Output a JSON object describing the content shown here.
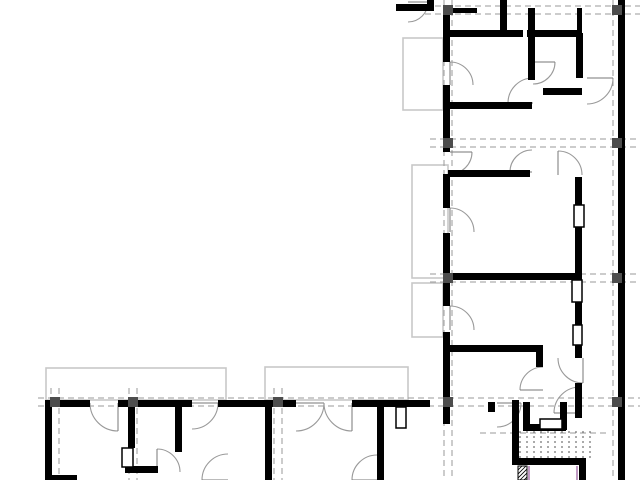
{
  "canvas": {
    "width": 640,
    "height": 480,
    "background": "#ffffff"
  },
  "colors": {
    "wall": "#000000",
    "grid": "#9a9a9a",
    "door_arc": "#999999",
    "balcony_outline": "#c8c8c8",
    "column": "#4d4d4d",
    "stair_tread": "#555555",
    "accent_magenta": "#96579b",
    "frame_border": "#000000",
    "frame_fill": "#ffffff"
  },
  "plan": {
    "grid": {
      "pair_offset": 4,
      "dash": "6 4",
      "vertical_axes": [
        {
          "x": 55,
          "y1": 388,
          "y2": 480
        },
        {
          "x": 133,
          "y1": 388,
          "y2": 480
        },
        {
          "x": 278,
          "y1": 388,
          "y2": 480
        },
        {
          "x": 448,
          "y1": 0,
          "y2": 480
        },
        {
          "x": 617,
          "y1": 0,
          "y2": 480
        }
      ],
      "horizontal_axes": [
        {
          "y": 10,
          "x1": 425,
          "x2": 640
        },
        {
          "y": 143,
          "x1": 430,
          "x2": 640
        },
        {
          "y": 278,
          "x1": 430,
          "x2": 640
        },
        {
          "y": 402,
          "x1": 38,
          "x2": 640
        }
      ],
      "extra_dashed_lines": [
        [
          480,
          433,
          610,
          433
        ]
      ]
    },
    "balconies": [
      [
        46,
        368,
        180,
        32
      ],
      [
        265,
        367,
        143,
        33
      ],
      [
        403,
        38,
        40,
        72
      ],
      [
        412,
        165,
        36,
        113
      ],
      [
        412,
        283,
        31,
        54
      ]
    ],
    "walls": [
      [
        443,
        8,
        7,
        54
      ],
      [
        443,
        85,
        7,
        67
      ],
      [
        443,
        174,
        7,
        34
      ],
      [
        443,
        233,
        7,
        73
      ],
      [
        443,
        332,
        7,
        70
      ],
      [
        443,
        402,
        7,
        22
      ],
      [
        618,
        0,
        7,
        480
      ],
      [
        500,
        0,
        7,
        35
      ],
      [
        528,
        8,
        7,
        72
      ],
      [
        577,
        8,
        5,
        25
      ],
      [
        443,
        30,
        80,
        7
      ],
      [
        527,
        30,
        53,
        7
      ],
      [
        452,
        8,
        25,
        5
      ],
      [
        396,
        4,
        38,
        7
      ],
      [
        427,
        0,
        7,
        11
      ],
      [
        448,
        102,
        84,
        7
      ],
      [
        543,
        88,
        39,
        7
      ],
      [
        576,
        33,
        7,
        45
      ],
      [
        448,
        170,
        82,
        7
      ],
      [
        575,
        177,
        7,
        28
      ],
      [
        575,
        227,
        7,
        53
      ],
      [
        575,
        302,
        7,
        23
      ],
      [
        575,
        345,
        7,
        13
      ],
      [
        575,
        383,
        7,
        19
      ],
      [
        448,
        273,
        129,
        7
      ],
      [
        450,
        345,
        90,
        7
      ],
      [
        536,
        345,
        7,
        22
      ],
      [
        512,
        400,
        7,
        62
      ],
      [
        512,
        458,
        74,
        7
      ],
      [
        579,
        458,
        7,
        22
      ],
      [
        523,
        402,
        7,
        22
      ],
      [
        523,
        424,
        43,
        7
      ],
      [
        560,
        402,
        7,
        28
      ],
      [
        575,
        402,
        7,
        16
      ],
      [
        488,
        402,
        7,
        10
      ],
      [
        45,
        400,
        45,
        7
      ],
      [
        118,
        400,
        74,
        7
      ],
      [
        218,
        400,
        78,
        7
      ],
      [
        352,
        400,
        78,
        7
      ],
      [
        45,
        400,
        7,
        80
      ],
      [
        128,
        402,
        7,
        46
      ],
      [
        125,
        466,
        33,
        7
      ],
      [
        175,
        402,
        7,
        50
      ],
      [
        265,
        402,
        7,
        78
      ],
      [
        377,
        402,
        7,
        78
      ],
      [
        45,
        475,
        32,
        5
      ]
    ],
    "door_arcs": [
      [
        450,
        85,
        23,
        -90,
        0
      ],
      [
        450,
        152,
        22,
        0,
        90
      ],
      [
        450,
        232,
        24,
        -90,
        0
      ],
      [
        450,
        330,
        24,
        -90,
        0
      ],
      [
        533,
        62,
        22,
        0,
        90
      ],
      [
        533,
        103,
        25,
        180,
        270
      ],
      [
        532,
        172,
        22,
        180,
        270
      ],
      [
        558,
        175,
        24,
        270,
        360
      ],
      [
        587,
        78,
        26,
        0,
        90
      ],
      [
        583,
        358,
        25,
        90,
        180
      ],
      [
        543,
        390,
        23,
        180,
        270
      ],
      [
        497,
        403,
        24,
        0,
        90
      ],
      [
        580,
        413,
        26,
        180,
        270
      ],
      [
        118,
        403,
        28,
        90,
        180
      ],
      [
        192,
        403,
        26,
        0,
        90
      ],
      [
        296,
        403,
        28,
        0,
        90
      ],
      [
        352,
        403,
        28,
        90,
        180
      ],
      [
        408,
        2,
        20,
        0,
        90
      ],
      [
        157,
        472,
        23,
        270,
        360
      ],
      [
        377,
        480,
        25,
        180,
        270
      ],
      [
        228,
        480,
        26,
        180,
        270
      ]
    ],
    "door_frames": [
      [
        574,
        205,
        10,
        22
      ],
      [
        572,
        280,
        10,
        22
      ],
      [
        573,
        325,
        9,
        20
      ],
      [
        540,
        419,
        22,
        10
      ],
      [
        396,
        407,
        10,
        21
      ],
      [
        122,
        448,
        11,
        19
      ]
    ],
    "columns": {
      "size": 10,
      "positions": [
        [
          448,
          10
        ],
        [
          617,
          10
        ],
        [
          448,
          143
        ],
        [
          617,
          143
        ],
        [
          448,
          278
        ],
        [
          617,
          278
        ],
        [
          448,
          402
        ],
        [
          617,
          402
        ],
        [
          55,
          402
        ],
        [
          133,
          402
        ],
        [
          278,
          402
        ]
      ]
    },
    "stair": {
      "x1": 520,
      "x2": 596,
      "step": 7,
      "y1": 431,
      "y2": 459,
      "dash": "2 3"
    },
    "elevator": {
      "hatch_rect": [
        518,
        466,
        9,
        14
      ],
      "accent_lines": [
        [
          529,
          466,
          529,
          480
        ],
        [
          577,
          466,
          577,
          480
        ]
      ]
    }
  }
}
